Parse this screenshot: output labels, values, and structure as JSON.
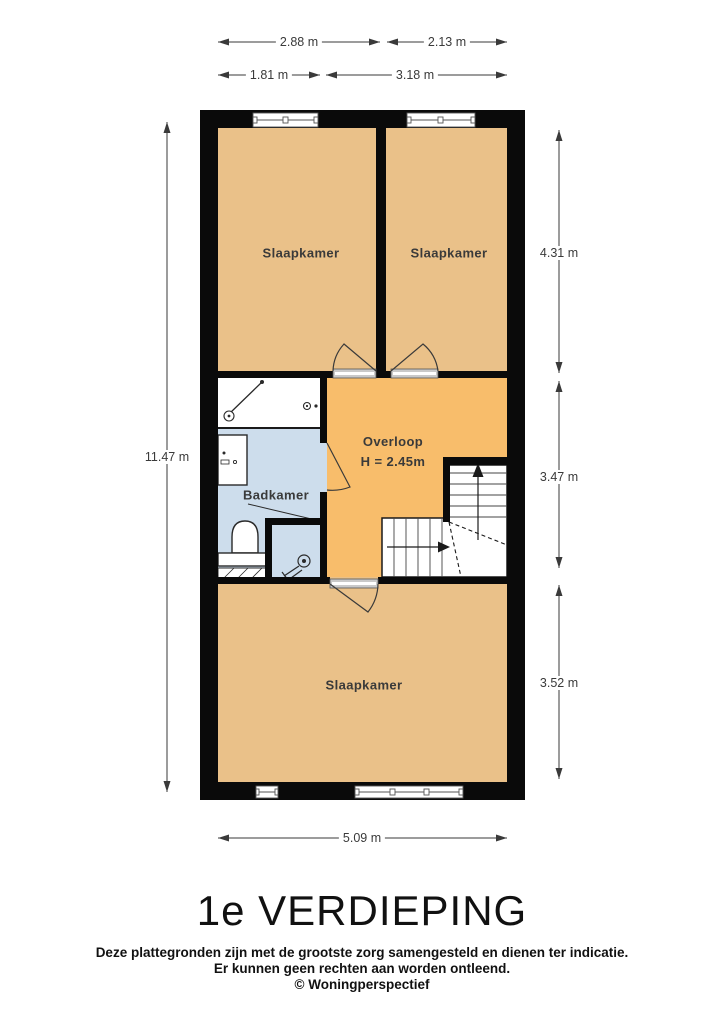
{
  "floor_title": "1e VERDIEPING",
  "disclaimer": {
    "line1": "Deze plattegronden zijn met de grootste zorg samengesteld en dienen ter indicatie.",
    "line2": "Er kunnen geen rechten aan worden ontleend.",
    "line3": "© Woningperspectief"
  },
  "rooms": {
    "bedroom_top_left": {
      "label": "Slaapkamer"
    },
    "bedroom_top_right": {
      "label": "Slaapkamer"
    },
    "bathroom": {
      "label": "Badkamer"
    },
    "landing": {
      "label": "Overloop",
      "ceiling_height": "H = 2.45m"
    },
    "bedroom_bottom": {
      "label": "Slaapkamer"
    }
  },
  "dimensions": {
    "top_outer_left": "2.88 m",
    "top_outer_right": "2.13 m",
    "top_inner_left": "1.81 m",
    "top_inner_right": "3.18 m",
    "left_total": "11.47 m",
    "right_top": "4.31 m",
    "right_middle": "3.47 m",
    "right_bottom": "3.52 m",
    "bottom_width": "5.09 m"
  },
  "colors": {
    "bedroom_fill": "#EAC189",
    "landing_fill": "#F8BD6B",
    "bathroom_fill": "#CDDDEC",
    "wall": "#0a0a0a",
    "dimension_lines": "#3a3a3a"
  }
}
